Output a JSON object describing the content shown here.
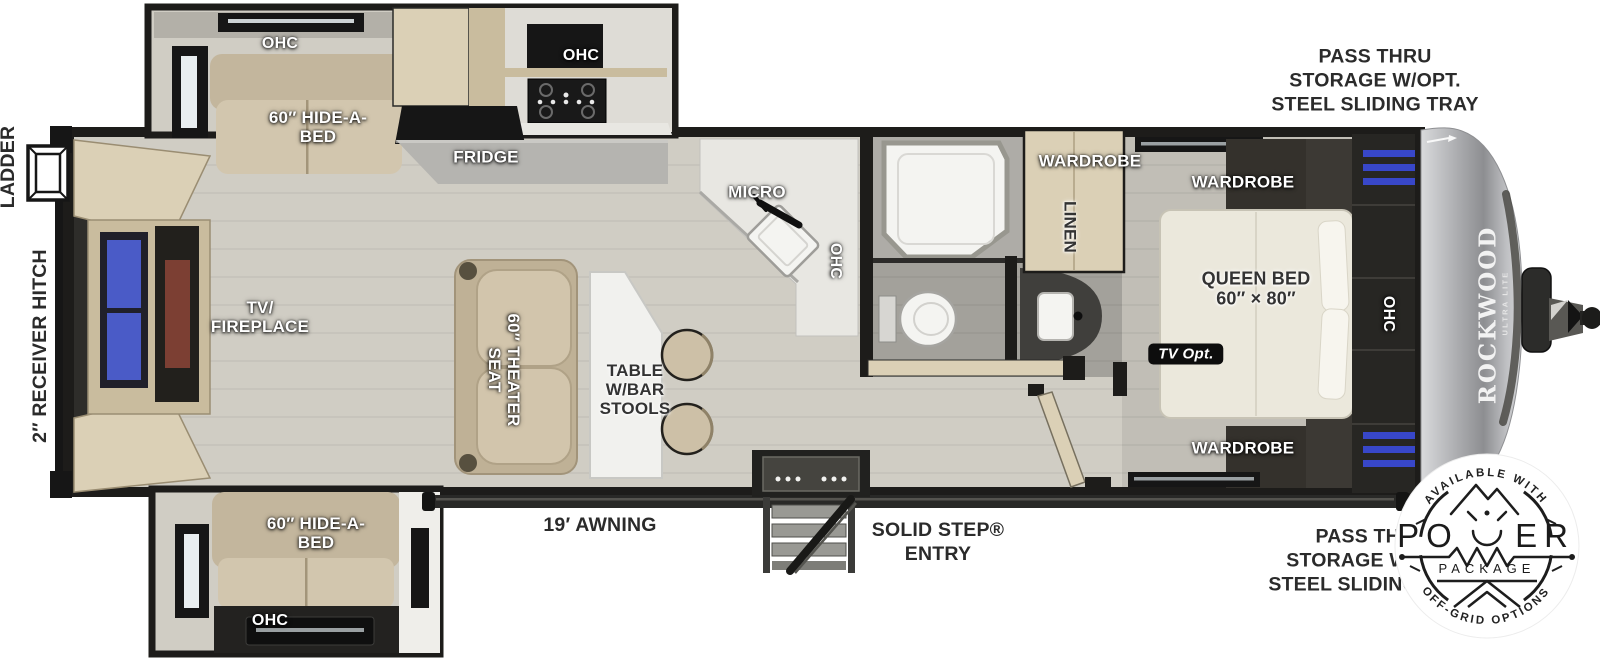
{
  "meta": {
    "product": "ROCKWOOD",
    "product_sub": "ULTRA LITE"
  },
  "colors": {
    "wall": "#1d1c1a",
    "floor": "#d0cdc4",
    "floor_bed": "#c1beb6",
    "floor_bath": "#a3a19b",
    "wood": "#dbd0b6",
    "wood_dark": "#c9bc9e",
    "sofa": "#c3b69d",
    "sofa_seat": "#d2c6ae",
    "appliance": "#161616",
    "counter": "#b5b4b0",
    "counter_white": "#e8e7e2",
    "tv_screen": "#4a5bc7",
    "fireplace": "#7c3f33",
    "led": "#3847c9",
    "badge_ink": "#1d1d1d"
  },
  "exterior": {
    "pass_thru_top": "PASS THRU\nSTORAGE W/OPT.\nSTEEL SLIDING TRAY",
    "pass_thru_bottom": "PASS THRU\nSTORAGE W/OPT.\nSTEEL SLIDING TRAY",
    "ladder": "LADDER",
    "receiver_hitch": "2″ RECEIVER HITCH",
    "awning": "19′ AWNING",
    "entry": "SOLID STEP®\nENTRY"
  },
  "rooms": {
    "ohc_top_slide": "OHC",
    "hide_a_bed_top": "60″ HIDE-A-\nBED",
    "fridge": "FRIDGE",
    "ohc_range": "OHC",
    "micro": "MICRO",
    "ohc_sink": "OHC",
    "tv_fireplace": "TV/\nFIREPLACE",
    "theater_seat": "60″ THEATER\nSEAT",
    "table_bar_stools": "TABLE\nW/BAR\nSTOOLS",
    "wardrobe_bath": "WARDROBE",
    "linen": "LINEN",
    "wardrobe_bed_top": "WARDROBE",
    "queen_bed": "QUEEN BED\n60″ × 80″",
    "tv_opt": "TV Opt.",
    "ohc_bed": "OHC",
    "wardrobe_bed_bottom": "WARDROBE",
    "hide_a_bed_bottom": "60″ HIDE-A-\nBED",
    "ohc_bottom_slide": "OHC"
  },
  "badge": {
    "arc_top": "AVAILABLE WITH",
    "power_left": "PO",
    "power_right": "ER",
    "package": "PACKAGE",
    "arc_bottom": "OFF-GRID OPTIONS"
  }
}
